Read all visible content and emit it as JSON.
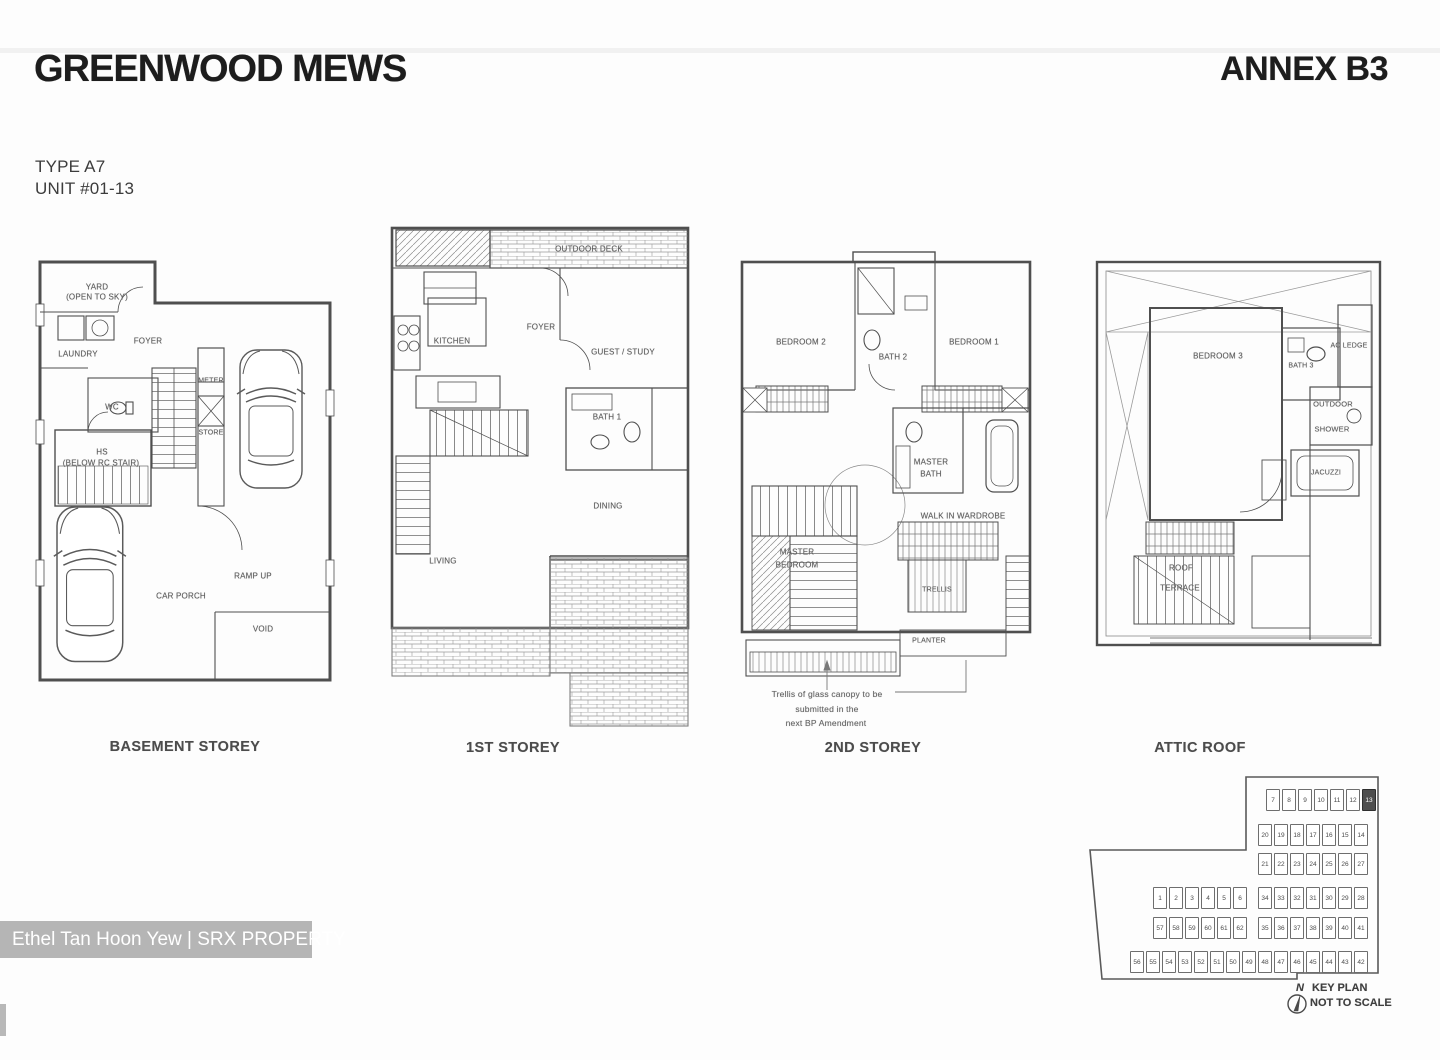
{
  "page": {
    "title": "GREENWOOD MEWS",
    "annex": "ANNEX B3",
    "type_label": "TYPE A7",
    "unit_label": "UNIT #01-13",
    "watermark": "Ethel Tan Hoon Yew | SRX PROPERTY"
  },
  "plans": {
    "basement": {
      "caption": "BASEMENT STOREY",
      "labels": {
        "yard1": "YARD",
        "yard2": "(OPEN TO SKY)",
        "foyer": "FOYER",
        "laundry": "LAUNDRY",
        "wc": "WC",
        "meter": "METER",
        "store": "STORE",
        "hs1": "HS",
        "hs2": "(BELOW RC STAIR)",
        "ramp": "RAMP UP",
        "carporch": "CAR PORCH",
        "void": "VOID"
      }
    },
    "first": {
      "caption": "1ST STOREY",
      "labels": {
        "deck": "OUTDOOR DECK",
        "kitchen": "KITCHEN",
        "foyer": "FOYER",
        "guest": "GUEST / STUDY",
        "bath1": "BATH 1",
        "dining": "DINING",
        "living": "LIVING"
      }
    },
    "second": {
      "caption": "2ND STOREY",
      "labels": {
        "bedroom2": "BEDROOM 2",
        "bath2": "BATH 2",
        "bedroom1": "BEDROOM 1",
        "mbath1": "MASTER",
        "mbath2": "BATH",
        "wiw": "WALK IN WARDROBE",
        "mbed1": "MASTER",
        "mbed2": "BEDROOM",
        "trellis": "TRELLIS",
        "planter": "PLANTER"
      },
      "note": [
        "Trellis of glass canopy to be",
        "submitted in the",
        "next BP Amendment"
      ]
    },
    "attic": {
      "caption": "ATTIC ROOF",
      "labels": {
        "bedroom3": "BEDROOM 3",
        "bath3": "BATH 3",
        "acledge": "AC LEDGE",
        "outdoor": "OUTDOOR",
        "shower": "SHOWER",
        "jacuzzi": "JACUZZI",
        "roof1": "ROOF",
        "roof2": "TERRACE"
      }
    }
  },
  "key_plan": {
    "north_label": "N",
    "title": "KEY PLAN",
    "subtitle": "NOT TO SCALE",
    "highlighted_unit": "13",
    "rows": {
      "rowA": [
        "7",
        "8",
        "9",
        "10",
        "11",
        "12",
        "13"
      ],
      "rowB": [
        "20",
        "19",
        "18",
        "17",
        "16",
        "15",
        "14"
      ],
      "rowC": [
        "21",
        "22",
        "23",
        "24",
        "25",
        "26",
        "27"
      ],
      "rowDL": [
        "1",
        "2",
        "3",
        "4",
        "5",
        "6"
      ],
      "rowDR": [
        "34",
        "33",
        "32",
        "31",
        "30",
        "29",
        "28"
      ],
      "rowEL": [
        "57",
        "58",
        "59",
        "60",
        "61",
        "62"
      ],
      "rowER": [
        "35",
        "36",
        "37",
        "38",
        "39",
        "40",
        "41"
      ],
      "rowFL": [
        "56",
        "55",
        "54",
        "53",
        "52",
        "51",
        "50",
        "49"
      ],
      "rowFR": [
        "48",
        "47",
        "46",
        "45",
        "44",
        "43",
        "42"
      ]
    }
  }
}
